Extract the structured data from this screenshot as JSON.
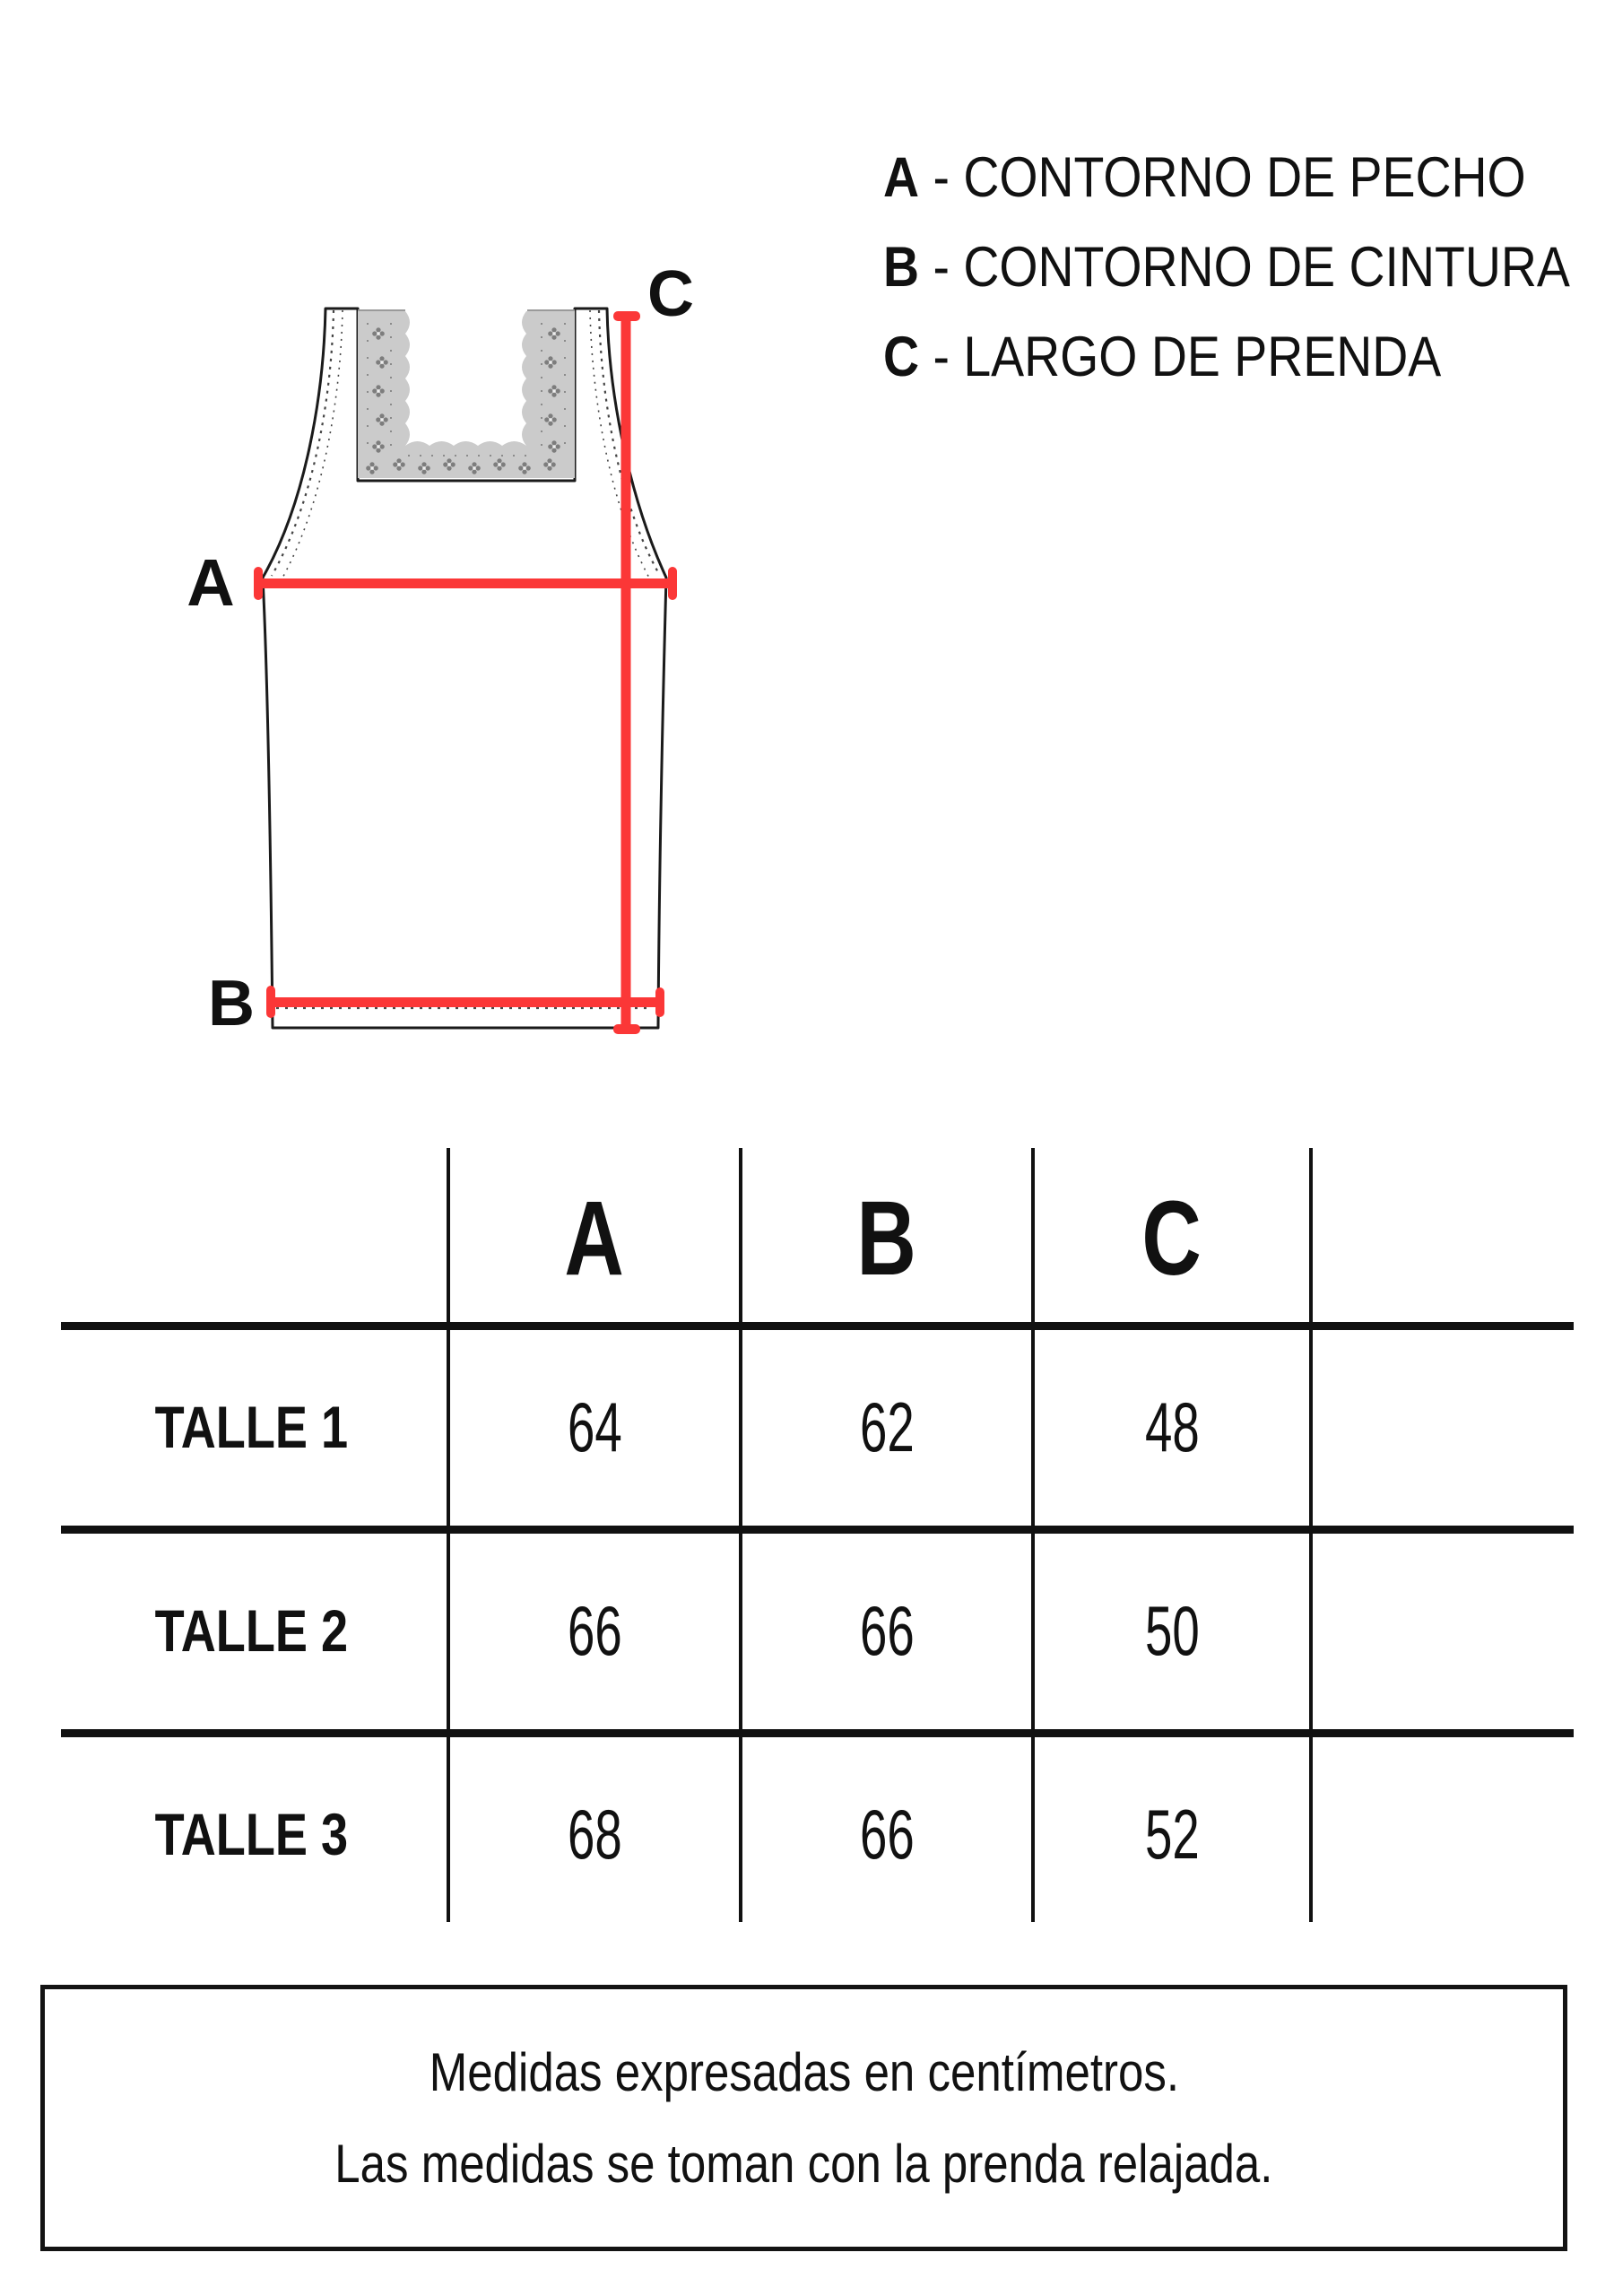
{
  "diagram": {
    "label_a": "A",
    "label_b": "B",
    "label_c": "C"
  },
  "legend": {
    "items": [
      {
        "letter": "A",
        "text": "- CONTORNO DE PECHO"
      },
      {
        "letter": "B",
        "text": "- CONTORNO DE CINTURA"
      },
      {
        "letter": "C",
        "text": "- LARGO DE PRENDA"
      }
    ]
  },
  "table": {
    "headers": [
      "A",
      "B",
      "C"
    ],
    "rows": [
      {
        "label": "TALLE 1",
        "values": [
          "64",
          "62",
          "48"
        ]
      },
      {
        "label": "TALLE 2",
        "values": [
          "66",
          "66",
          "50"
        ]
      },
      {
        "label": "TALLE 3",
        "values": [
          "68",
          "66",
          "52"
        ]
      }
    ]
  },
  "notes": {
    "line1": "Medidas expresadas en centímetros.",
    "line2": "Las medidas se toman con la prenda relajada."
  },
  "colors": {
    "accent_red": "#fb3737",
    "lace_grey": "#cbcbcb",
    "ink": "#111111"
  }
}
